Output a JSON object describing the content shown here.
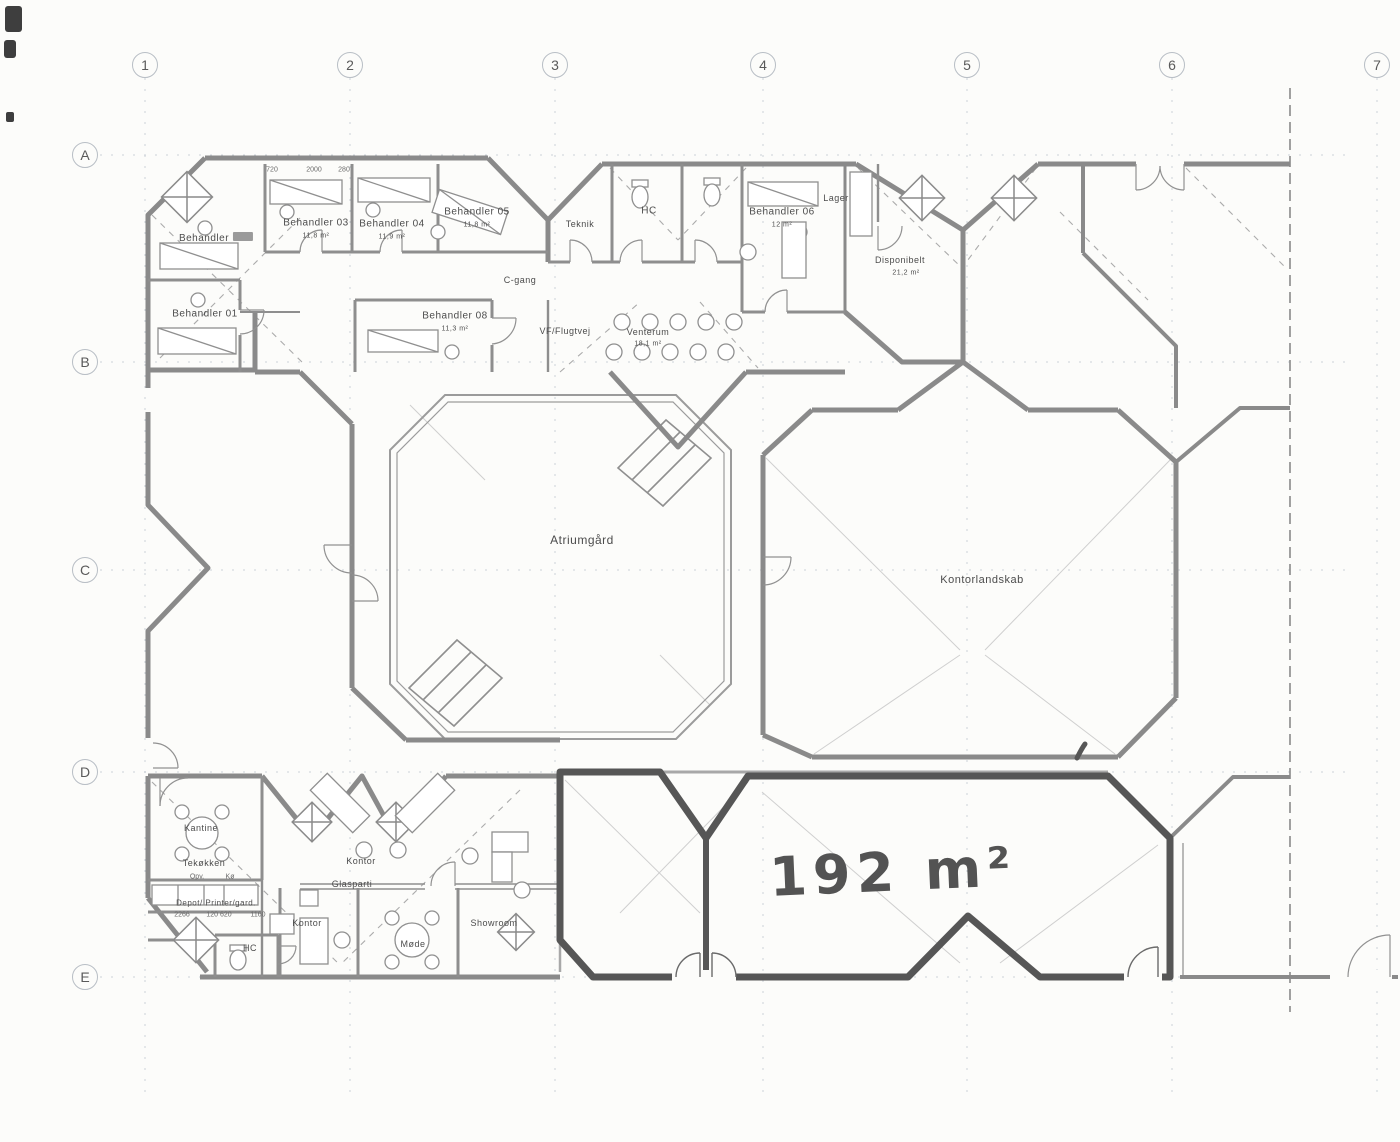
{
  "drawing": {
    "type": "architectural-floor-plan",
    "annotation_handwritten": "192 m²",
    "colors": {
      "wall_gray": "#8a8a8a",
      "marker_dark": "#565656",
      "grid_gray": "#ccd2d8",
      "paper": "#fcfcfa"
    }
  },
  "grid": {
    "columns": [
      {
        "label": "1",
        "x": 145
      },
      {
        "label": "2",
        "x": 350
      },
      {
        "label": "3",
        "x": 555
      },
      {
        "label": "4",
        "x": 763
      },
      {
        "label": "5",
        "x": 967
      },
      {
        "label": "6",
        "x": 1172
      },
      {
        "label": "7",
        "x": 1377
      }
    ],
    "rows": [
      {
        "label": "A",
        "y": 155
      },
      {
        "label": "B",
        "y": 362
      },
      {
        "label": "C",
        "y": 570
      },
      {
        "label": "D",
        "y": 772
      },
      {
        "label": "E",
        "y": 977
      }
    ]
  },
  "rooms": [
    {
      "id": "behandler-02",
      "label": "Behandler",
      "x": 216,
      "y": 238,
      "size": 10,
      "smudge": true
    },
    {
      "id": "behandler-01",
      "label": "Behandler 01",
      "x": 205,
      "y": 314,
      "size": 10
    },
    {
      "id": "behandler-03",
      "label": "Behandler 03",
      "x": 316,
      "y": 223,
      "size": 10
    },
    {
      "id": "behandler-03-area",
      "label": "11,8 m²",
      "x": 316,
      "y": 236,
      "size": 7
    },
    {
      "id": "behandler-04",
      "label": "Behandler 04",
      "x": 392,
      "y": 224,
      "size": 10
    },
    {
      "id": "behandler-04-area",
      "label": "11,9 m²",
      "x": 392,
      "y": 237,
      "size": 7
    },
    {
      "id": "behandler-05",
      "label": "Behandler 05",
      "x": 477,
      "y": 212,
      "size": 10
    },
    {
      "id": "behandler-05-area",
      "label": "11,8 m²",
      "x": 477,
      "y": 225,
      "size": 7
    },
    {
      "id": "teknik",
      "label": "Teknik",
      "x": 580,
      "y": 224,
      "size": 9
    },
    {
      "id": "hc-top",
      "label": "HC",
      "x": 649,
      "y": 211,
      "size": 10
    },
    {
      "id": "behandler-06",
      "label": "Behandler 06",
      "x": 782,
      "y": 212,
      "size": 10
    },
    {
      "id": "behandler-06-area",
      "label": "12 m²",
      "x": 782,
      "y": 225,
      "size": 7
    },
    {
      "id": "lager",
      "label": "Lager",
      "x": 836,
      "y": 198,
      "size": 9
    },
    {
      "id": "disponibelt",
      "label": "Disponibelt",
      "x": 900,
      "y": 260,
      "size": 9
    },
    {
      "id": "disponibelt-area",
      "label": "21,2 m²",
      "x": 906,
      "y": 273,
      "size": 7
    },
    {
      "id": "c-gang",
      "label": "C-gang",
      "x": 520,
      "y": 280,
      "size": 9
    },
    {
      "id": "behandler-08",
      "label": "Behandler 08",
      "x": 455,
      "y": 316,
      "size": 10
    },
    {
      "id": "behandler-08-area",
      "label": "11,3 m²",
      "x": 455,
      "y": 329,
      "size": 7
    },
    {
      "id": "vf-flugtvej",
      "label": "VF/Flugtvej",
      "x": 565,
      "y": 331,
      "size": 9
    },
    {
      "id": "venterum",
      "label": "Venterum",
      "x": 648,
      "y": 332,
      "size": 9
    },
    {
      "id": "venterum-area",
      "label": "18,1 m²",
      "x": 648,
      "y": 344,
      "size": 7
    },
    {
      "id": "atriumgaard",
      "label": "Atriumgård",
      "x": 582,
      "y": 540,
      "size": 12
    },
    {
      "id": "kontorlandskab",
      "label": "Kontorlandskab",
      "x": 982,
      "y": 580,
      "size": 11
    },
    {
      "id": "kantine",
      "label": "Kantine",
      "x": 201,
      "y": 828,
      "size": 9
    },
    {
      "id": "tekoekken",
      "label": "Tekøkken",
      "x": 204,
      "y": 863,
      "size": 9
    },
    {
      "id": "kontor",
      "label": "Kontor",
      "x": 361,
      "y": 861,
      "size": 9
    },
    {
      "id": "glasparti",
      "label": "Glasparti",
      "x": 352,
      "y": 884,
      "size": 9
    },
    {
      "id": "depot-printer-gard",
      "label": "Depot/ Printer/gard.",
      "x": 216,
      "y": 903,
      "size": 8
    },
    {
      "id": "hc-bottom",
      "label": "HC",
      "x": 250,
      "y": 948,
      "size": 9
    },
    {
      "id": "kontor-2",
      "label": "Kontor",
      "x": 307,
      "y": 923,
      "size": 9
    },
    {
      "id": "moede",
      "label": "Møde",
      "x": 413,
      "y": 944,
      "size": 9
    },
    {
      "id": "showroom",
      "label": "Showroom",
      "x": 494,
      "y": 923,
      "size": 9
    },
    {
      "id": "area-annotation",
      "label": "192 m²",
      "x": 893,
      "y": 872,
      "size": 54,
      "cls": "hand"
    }
  ],
  "small_texts": [
    {
      "text": "720",
      "x": 272,
      "y": 170
    },
    {
      "text": "2000",
      "x": 314,
      "y": 170
    },
    {
      "text": "280",
      "x": 344,
      "y": 170
    },
    {
      "text": "Opv.",
      "x": 197,
      "y": 877
    },
    {
      "text": "Kø",
      "x": 230,
      "y": 877
    },
    {
      "text": "2266",
      "x": 182,
      "y": 915
    },
    {
      "text": "120 620",
      "x": 219,
      "y": 915
    },
    {
      "text": "1160",
      "x": 258,
      "y": 915
    }
  ]
}
